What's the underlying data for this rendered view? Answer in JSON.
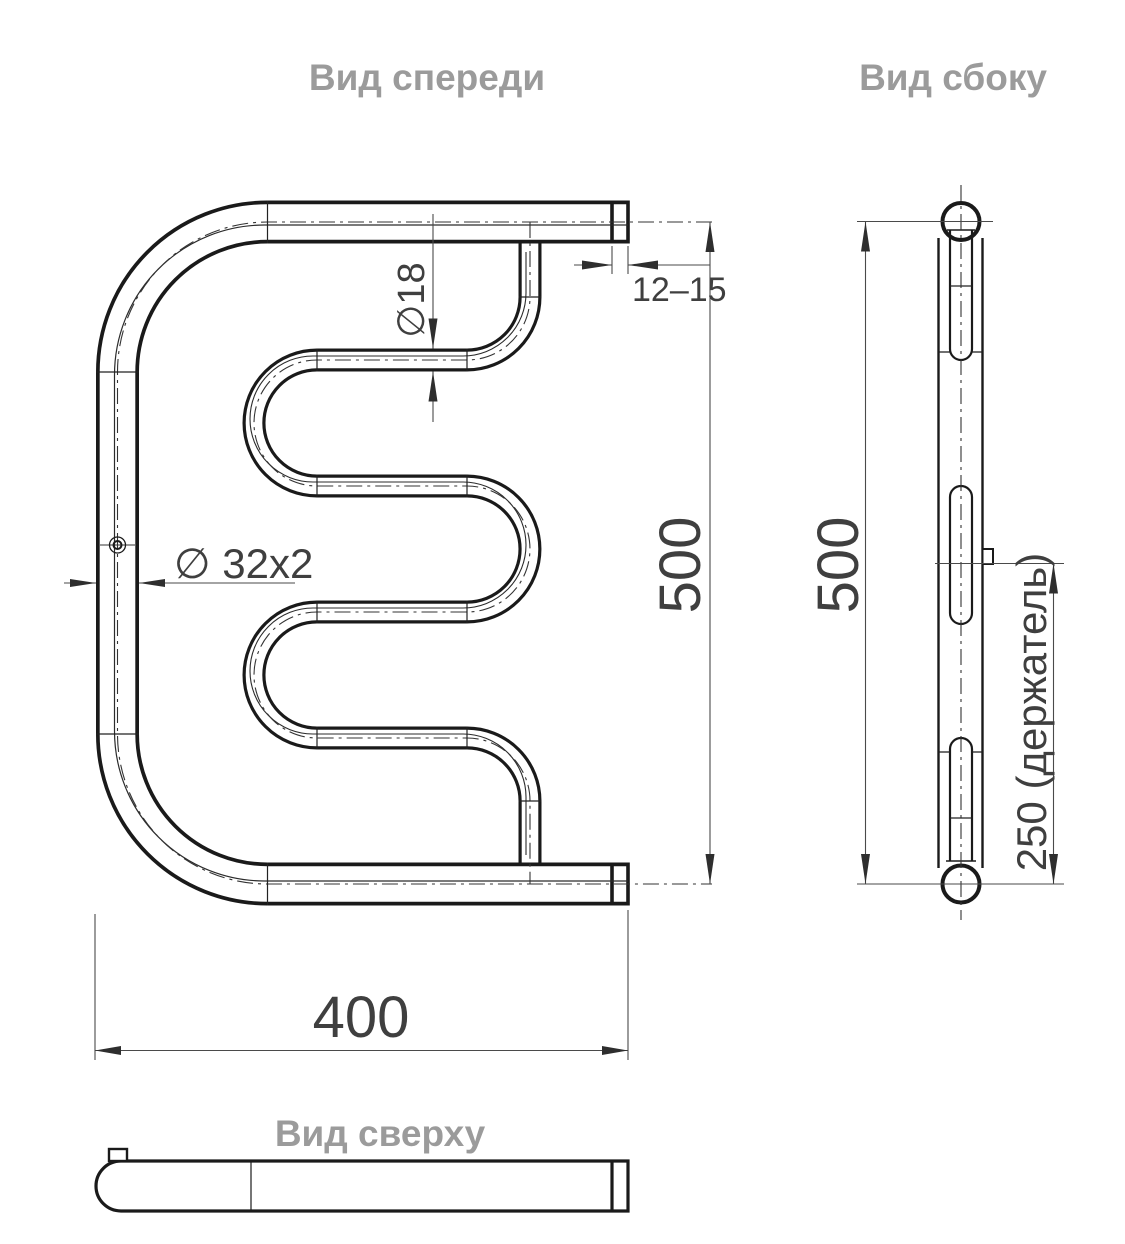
{
  "drawing": {
    "type": "technical-drawing",
    "subject": "towel-rail-three-views",
    "views": {
      "front": {
        "title": "Вид спереди"
      },
      "side": {
        "title": "Вид сбоку"
      },
      "top": {
        "title": "Вид сверху"
      }
    },
    "dimensions": {
      "tube_diameter": "∅18",
      "end_offset": "12–15",
      "front_height": "500",
      "pipe_spec": "∅ 32x2",
      "width": "400",
      "side_height": "500",
      "holder": "250 (держатель)"
    },
    "colors": {
      "line": "#1a1a1a",
      "dimension": "#3f3f3f",
      "dimension_line": "#4a4a4a",
      "title": "#9b9b9b",
      "background": "#ffffff"
    }
  }
}
